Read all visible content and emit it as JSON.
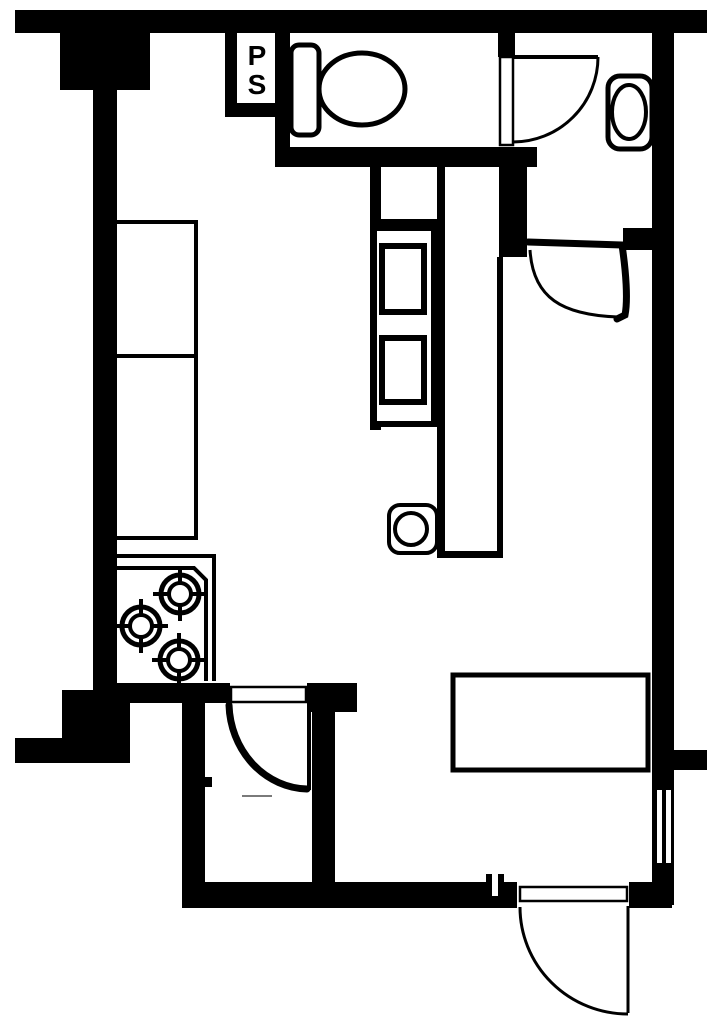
{
  "plan": {
    "ps_shaft_label": {
      "line1": "P",
      "line2": "S"
    },
    "colors": {
      "wall": "#000000",
      "paper": "#ffffff",
      "faint_mark": "#7a7a7a"
    },
    "fixture_icons": [
      "pipe-shaft",
      "toilet",
      "washbasin",
      "bathroom-door-swing",
      "powder-room-door-swing",
      "kitchen-counter",
      "gas-stove-three-burners",
      "shelf-unit",
      "washing-machine",
      "closet-door-swing",
      "entry-door-swing",
      "window",
      "table"
    ]
  }
}
